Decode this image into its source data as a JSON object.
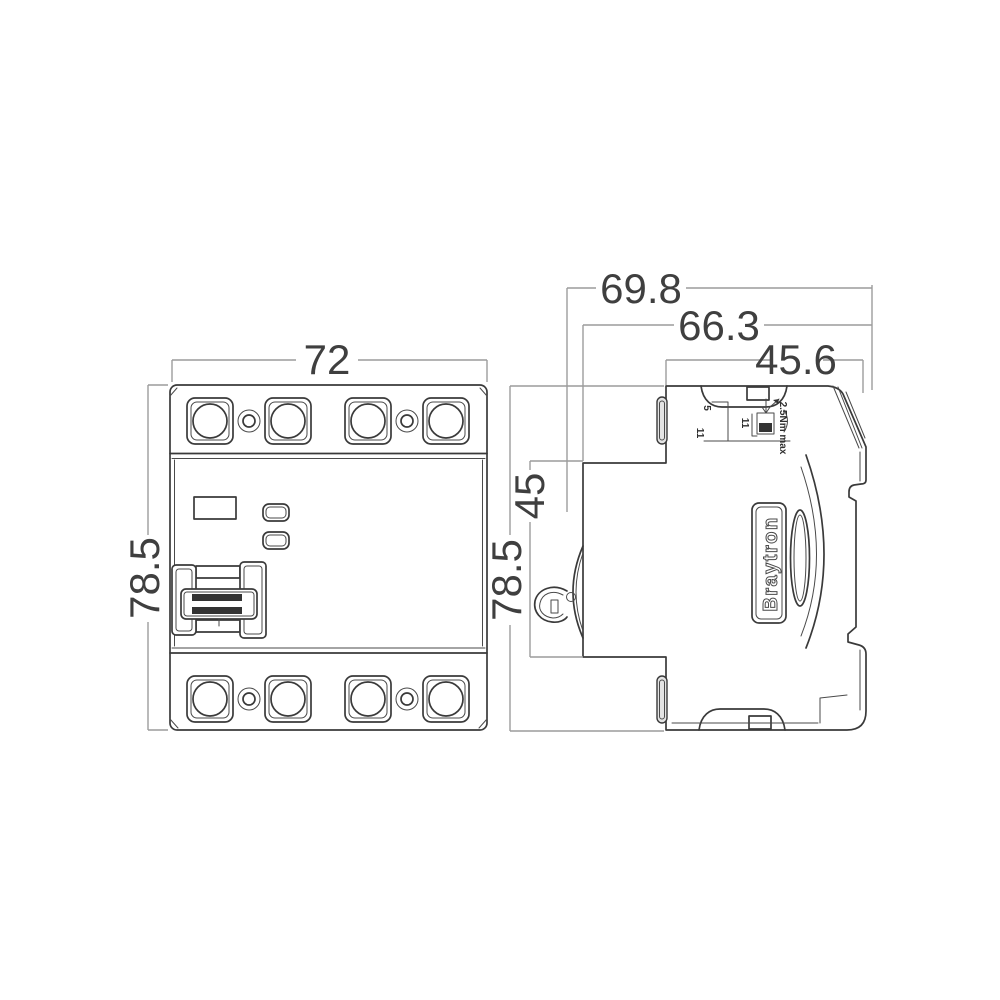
{
  "brand_label": "Braytron",
  "dimensions": {
    "front_width": "72",
    "front_height": "78.5",
    "side_height": "78.5",
    "rail_section_height": "45",
    "depth_total": "69.8",
    "depth_without_clip": "66.3",
    "depth_front_section": "45.6"
  },
  "annotations": {
    "strip_length_top": "5",
    "strip_length_left": "11",
    "terminal_depth": "11",
    "torque_note": "2.5Nm max"
  },
  "colors": {
    "outline": "#3a3a3a",
    "dimension_line": "#9c9c9c",
    "dimension_text": "#3f3f3f",
    "background": "#ffffff"
  }
}
